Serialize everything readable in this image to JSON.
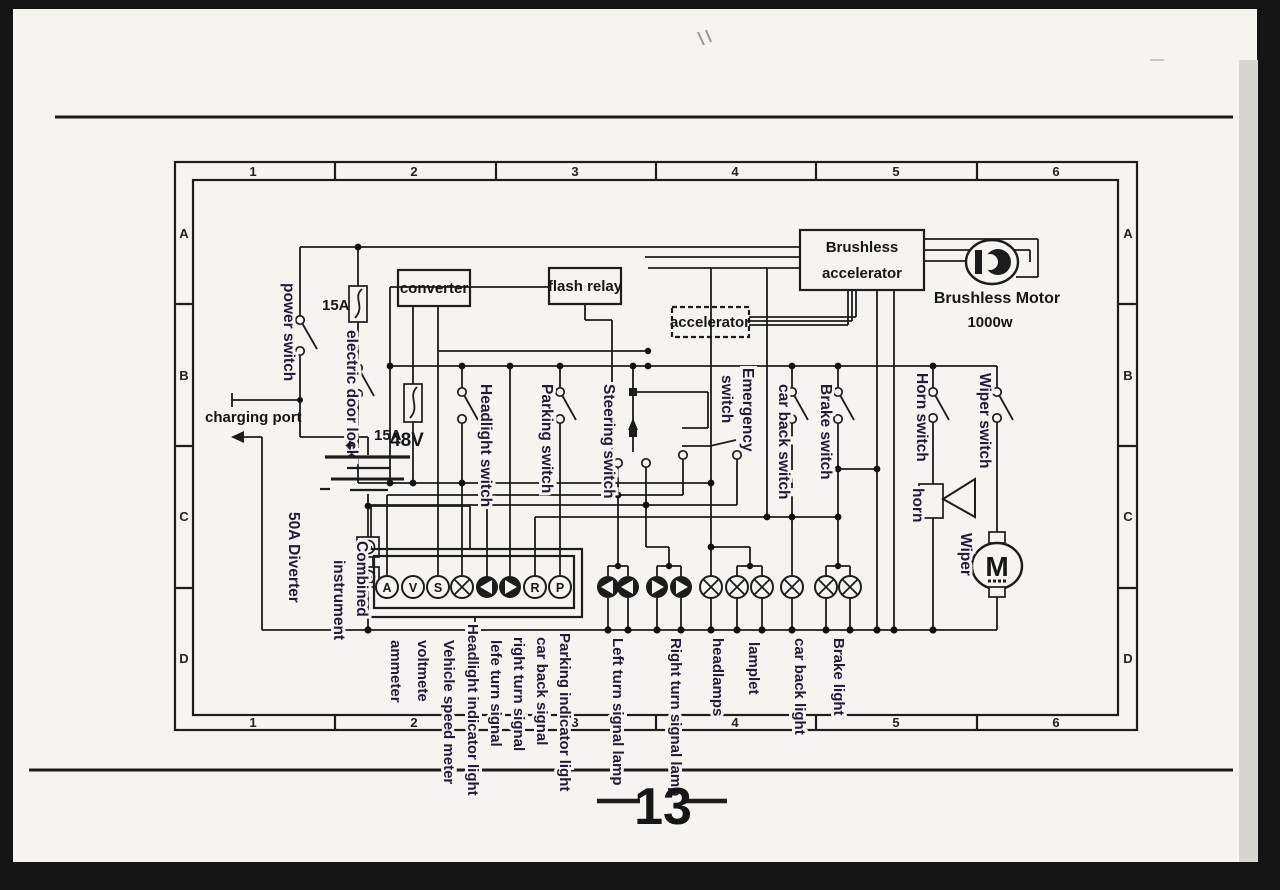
{
  "page": {
    "number": "13"
  },
  "grid": {
    "columns": [
      "1",
      "2",
      "3",
      "4",
      "5",
      "6"
    ],
    "rows": [
      "A",
      "B",
      "C",
      "D"
    ]
  },
  "power": {
    "power_switch": "power switch",
    "main_fuse": "15A",
    "secondary_fuse": "15A",
    "electric_door_lock": "electric door lock",
    "charging_port": "charging port",
    "battery_plus": "+",
    "battery_voltage": "48V",
    "diverter": "50A  Diverter"
  },
  "modules": {
    "converter": "converter",
    "flash_relay": "flash relay",
    "accelerator": "accelerator",
    "brushless_accelerator_line1": "Brushless",
    "brushless_accelerator_line2": "accelerator",
    "brushless_motor_name": "Brushless Motor",
    "brushless_motor_power": "1000w"
  },
  "instrument": {
    "label_line1": "Combined",
    "label_line2": "instrument",
    "gauges": [
      "A",
      "V",
      "S",
      "lamp-icon",
      "left-arrow-icon",
      "right-arrow-icon",
      "R",
      "P"
    ]
  },
  "switches": {
    "headlight": "Headlight switch",
    "parking": "Parking switch",
    "steering": "Steering switch",
    "emergency_word1": "Emergency",
    "emergency_word2": "switch",
    "car_back": "car back switch",
    "brake": "Brake switch",
    "horn": "Horn switch",
    "wiper": "Wiper switch"
  },
  "devices": {
    "horn": "horn",
    "wiper": "Wiper",
    "wiper_motor_letter": "M"
  },
  "outputs": [
    "ammeter",
    "voltmete",
    "Vehicle speed meter",
    "Headlight indicator light",
    "lefe turn signal",
    "right turn signal",
    "car back signal",
    "Parking indicator light",
    "Left turn signal lamp",
    "Right turn signal lamp",
    "headlamps",
    "lamplet",
    "car back light",
    "Brake light"
  ],
  "colors": {
    "line": "#1c1c1c",
    "label": "#241a33",
    "paper": "#f5f4f1"
  }
}
